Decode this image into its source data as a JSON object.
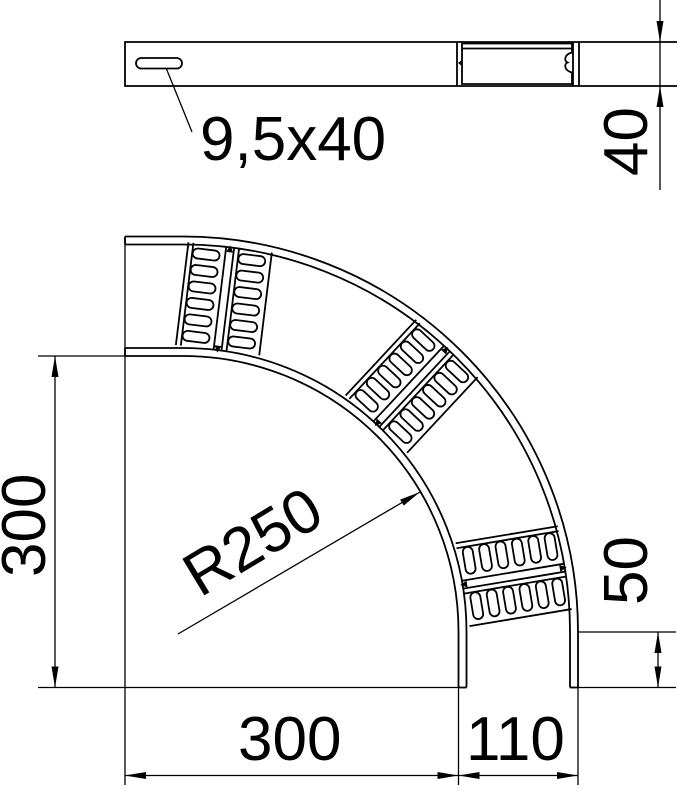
{
  "drawing": {
    "type": "technical-dimension-drawing",
    "side_view": {
      "slot_label": "9,5x40",
      "height_label": "40"
    },
    "plan_view": {
      "vertical_extent_label": "300",
      "radius_label": "R250",
      "tangent_length_label": "50",
      "horizontal_extent_label": "300",
      "width_label": "110"
    },
    "dimensions_mm": {
      "slot_size": "9,5x40",
      "side_rail_height": 40,
      "vertical_extent": 300,
      "bend_radius": 250,
      "tangent_length": 50,
      "horizontal_extent": 300,
      "ladder_width": 110
    },
    "colors": {
      "line": "#000000",
      "background": "#ffffff"
    }
  }
}
